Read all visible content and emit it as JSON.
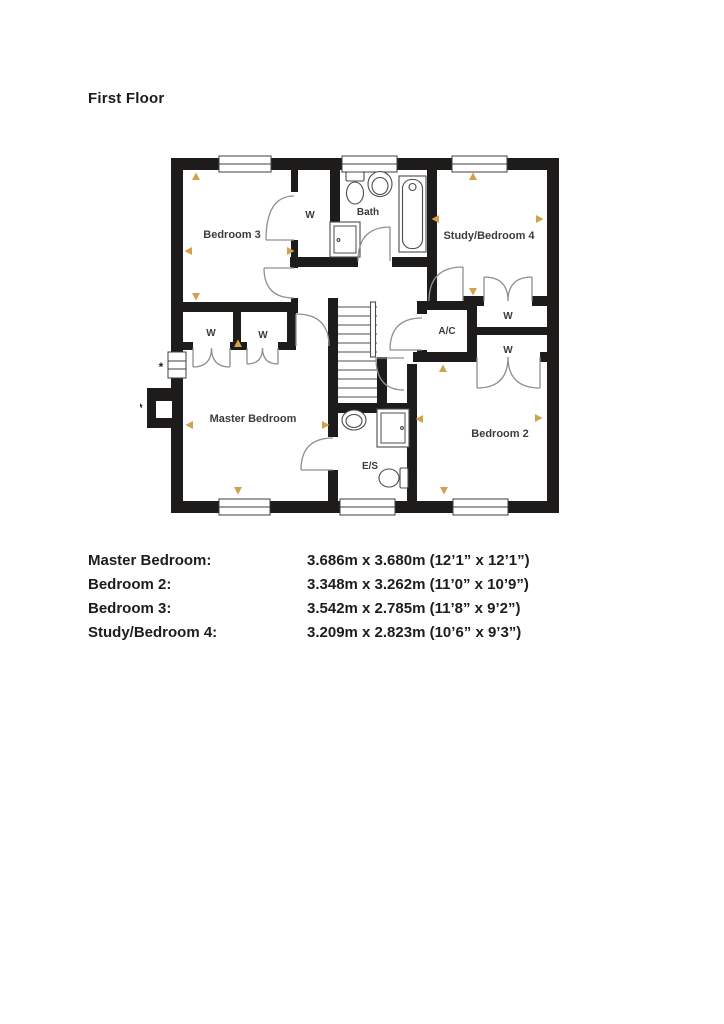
{
  "page": {
    "title": "First Floor"
  },
  "plan": {
    "rooms": {
      "bedroom3": "Bedroom 3",
      "bath": "Bath",
      "study_bedroom4": "Study/Bedroom 4",
      "ac": "A/C",
      "wardrobe": "W",
      "master_bedroom": "Master Bedroom",
      "ensuite": "E/S",
      "bedroom2": "Bedroom 2"
    },
    "footnotes": {
      "single": "*",
      "double": "**"
    },
    "colors": {
      "wall": "#1d1c1a",
      "marker": "#d2a04e",
      "fixture": "#4c4c4c",
      "door": "#8f8f8f",
      "label": "#3c3c3b"
    }
  },
  "dimensions": {
    "rows": [
      {
        "room": "Master Bedroom:",
        "size": "3.686m x 3.680m (12’1” x 12’1”)"
      },
      {
        "room": "Bedroom 2:",
        "size": "3.348m x 3.262m (11’0” x 10’9”)"
      },
      {
        "room": "Bedroom 3:",
        "size": "3.542m x 2.785m (11’8” x 9’2”)"
      },
      {
        "room": "Study/Bedroom 4:",
        "size": "3.209m x 2.823m (10’6” x 9’3”)"
      }
    ]
  }
}
